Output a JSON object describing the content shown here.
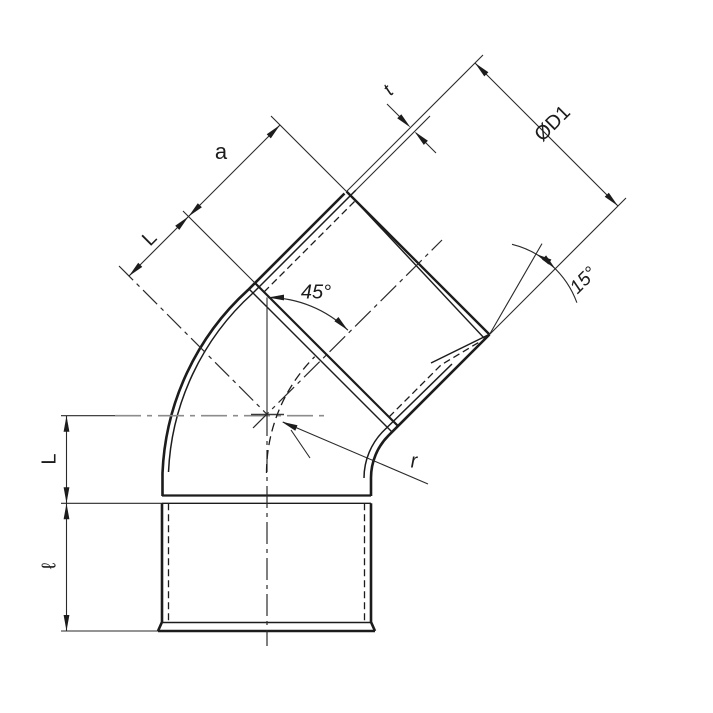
{
  "title": "45 degree socket elbow fitting - dimensioned technical drawing",
  "colors": {
    "background": "#ffffff",
    "line": "#1c1c1c",
    "dimension_line": "#2a2a2a",
    "centerline_gray": "#8c8c8c"
  },
  "labels": {
    "dim_a": {
      "text": "a"
    },
    "dim_L_upper": {
      "text": "L"
    },
    "dim_L_left": {
      "text": "L"
    },
    "dim_ell": {
      "text": "ℓ"
    },
    "angle_45": {
      "text": "45°"
    },
    "angle_15": {
      "text": "15°"
    },
    "dia_D1": {
      "text": "ØD1"
    },
    "thickness_t": {
      "text": "t"
    },
    "radius_r": {
      "text": "r"
    }
  }
}
